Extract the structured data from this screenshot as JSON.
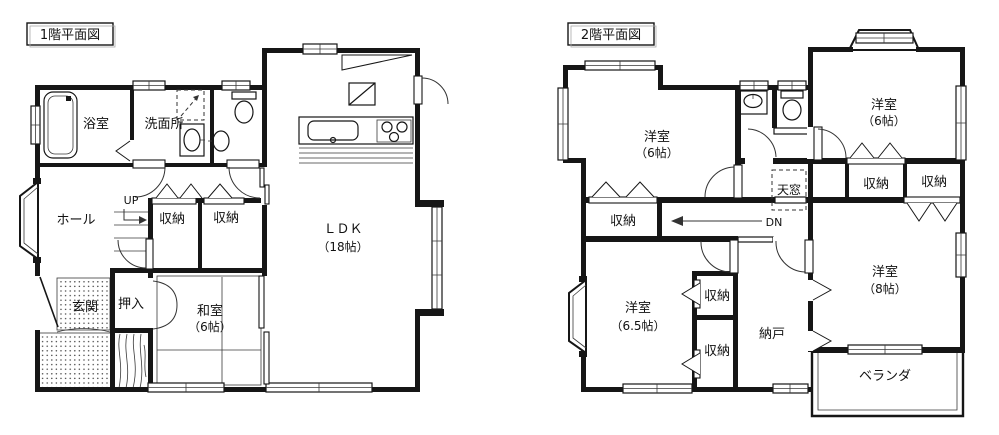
{
  "colors": {
    "line": "#161616",
    "bg": "#ffffff"
  },
  "floor1": {
    "title": "1階平面図",
    "bathroom": "浴室",
    "washroom": "洗面所",
    "hall": "ホール",
    "stairs_up": "UP",
    "closet1": "収納",
    "closet2": "収納",
    "entrance": "玄関",
    "oshiire": "押入",
    "tatami_room": "和室",
    "tatami_size": "（6帖）",
    "ldk": "ＬＤＫ",
    "ldk_size": "（18帖）"
  },
  "floor2": {
    "title": "2階平面図",
    "bedroom_nw": "洋室",
    "bedroom_nw_size": "（6帖）",
    "bedroom_ne": "洋室",
    "bedroom_ne_size": "（6帖）",
    "closet_a": "収納",
    "closet_b": "収納",
    "skylight": "天窓",
    "closet_c": "収納",
    "stairs_dn": "DN",
    "bedroom_sw": "洋室",
    "bedroom_sw_size": "（6.5帖）",
    "closet_d": "収納",
    "closet_e": "収納",
    "storeroom": "納戸",
    "bedroom_se": "洋室",
    "bedroom_se_size": "（8帖）",
    "veranda": "ベランダ"
  }
}
